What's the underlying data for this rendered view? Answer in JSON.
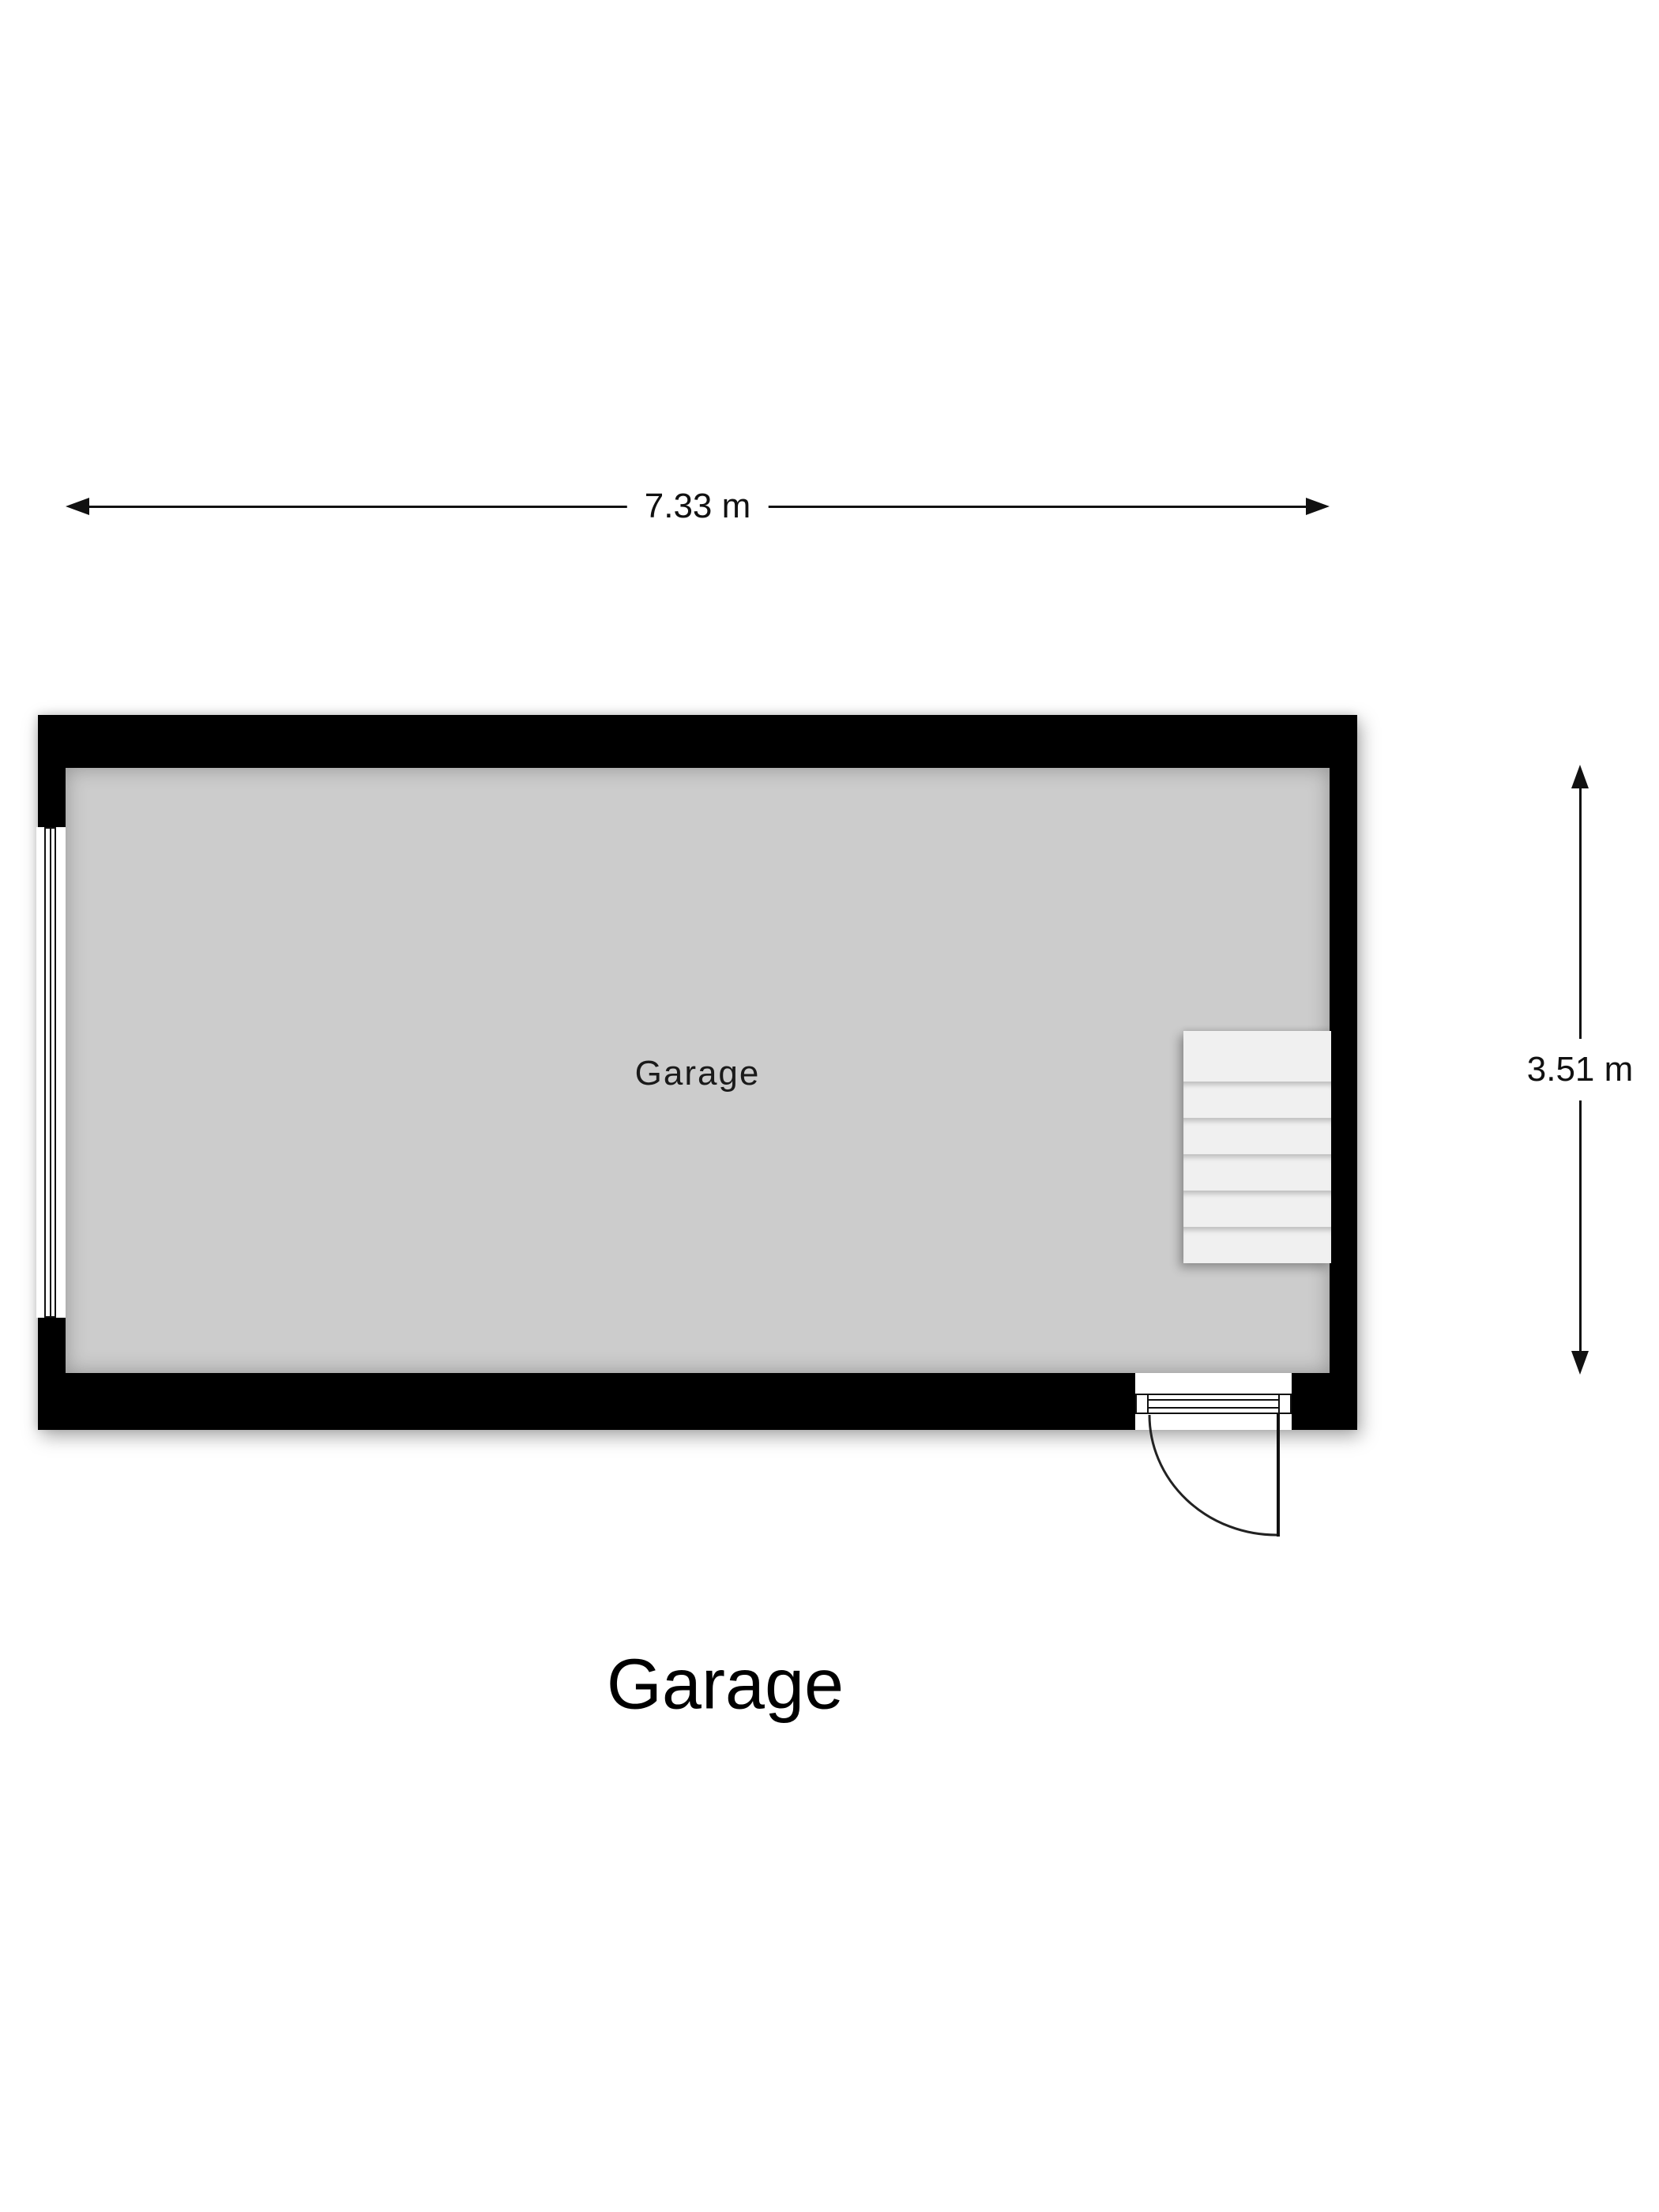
{
  "floorplan": {
    "title": "Garage",
    "room_label": "Garage",
    "dim_width": "7.33 m",
    "dim_height": "3.51 m",
    "stairs": {
      "steps": 6
    },
    "colors": {
      "wall": "#000000",
      "floor": "#cccccc",
      "stairs": "#f0f0f0",
      "line": "#111111",
      "background": "#ffffff"
    }
  }
}
